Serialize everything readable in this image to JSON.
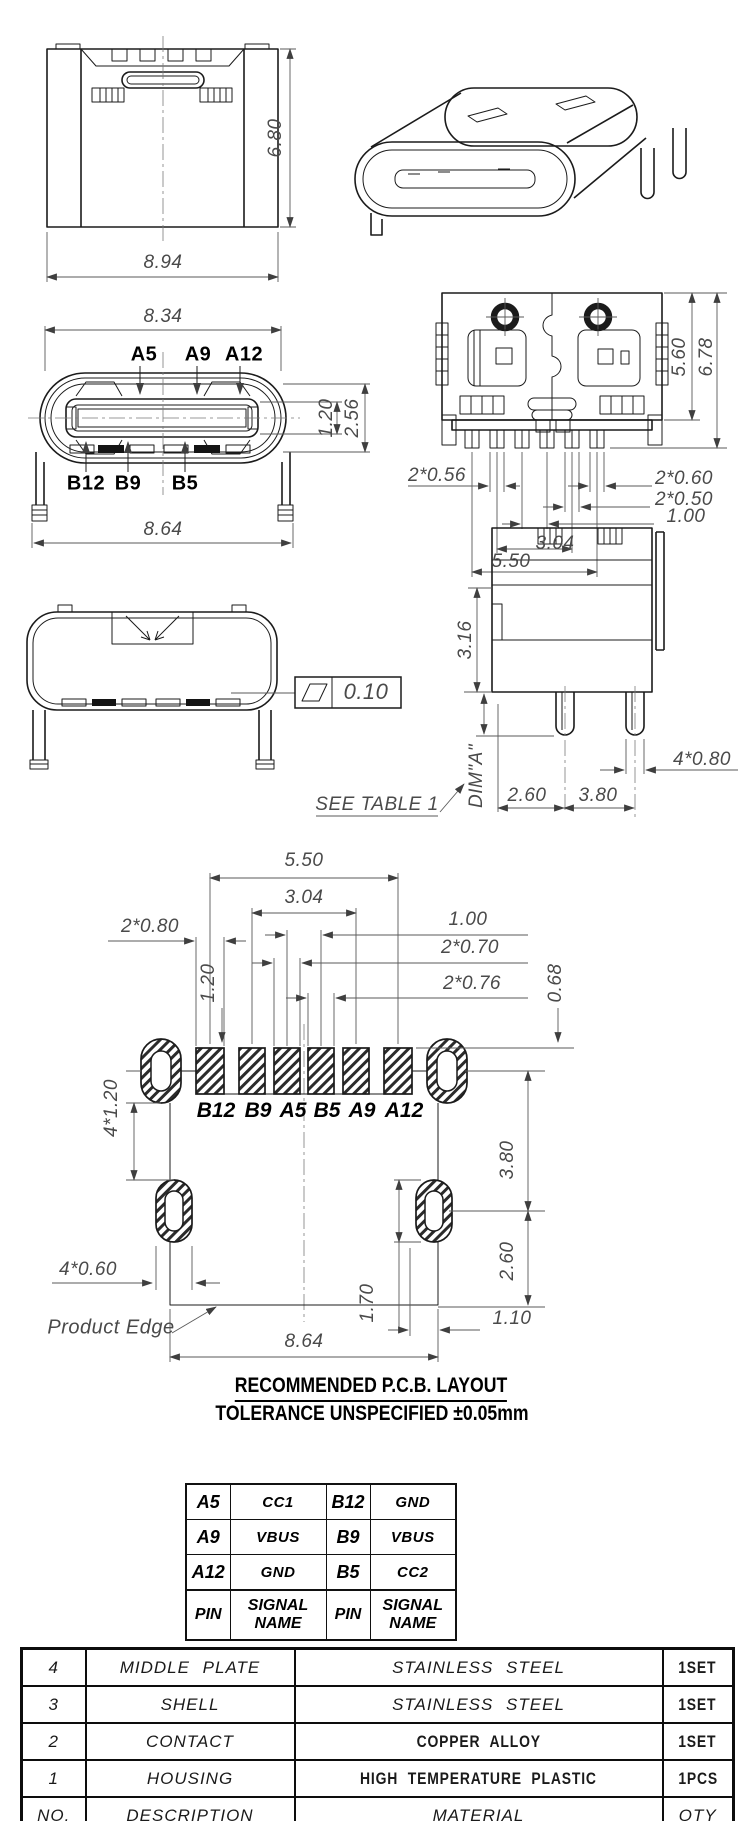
{
  "drawing": {
    "rear_view": {
      "height": "6.80",
      "width": "8.94"
    },
    "front_view": {
      "width_top": "8.34",
      "width_bottom": "8.64",
      "tongue_thickness": "1.20",
      "cavity_height": "2.56",
      "pin_labels_top": [
        "A5",
        "A9",
        "A12"
      ],
      "pin_labels_bottom": [
        "B12",
        "B9",
        "B5"
      ]
    },
    "bottom_view": {
      "body_height": "5.60",
      "total_height": "6.78",
      "pin_width_outer": "2*0.56",
      "pin_width_edge": "2*0.60",
      "pin_width_inner": "2*0.50",
      "pin_pitch_center": "1.00",
      "pin_span_mid": "3.04",
      "pin_span": "5.50"
    },
    "shell_view": {
      "flatness": "0.10",
      "see_table": "SEE  TABLE  1"
    },
    "side_view": {
      "height_above": "3.16",
      "dim_a": "DIM\"A\"",
      "leg_offset": "2.60",
      "leg_pitch": "3.80",
      "leg_width": "4*0.80"
    }
  },
  "pcb": {
    "title": "RECOMMENDED    P.C.B.  LAYOUT",
    "tolerance_note": "TOLERANCE  UNSPECIFIED  ±0.05mm",
    "product_edge_label": "Product Edge",
    "pad_labels": [
      "B12",
      "B9",
      "A5",
      "B5",
      "A9",
      "A12"
    ],
    "dims": {
      "pad_span": "5.50",
      "pad_span_mid": "3.04",
      "pad_pitch_center": "1.00",
      "pad_width_edge": "2*0.80",
      "pad_width_a": "2*0.70",
      "pad_width_b": "2*0.76",
      "offset_right": "0.68",
      "offset_left": "1.20",
      "hole_height": "4*1.20",
      "hole_width": "4*0.60",
      "hole_v_pitch": "3.80",
      "hole_edge_offset": "2.60",
      "slot_height": "1.70",
      "edge_offset": "1.10",
      "board_width": "8.64"
    }
  },
  "pin_table": {
    "rows": [
      [
        "A5",
        "CC1",
        "B12",
        "GND"
      ],
      [
        "A9",
        "VBUS",
        "B9",
        "VBUS"
      ],
      [
        "A12",
        "GND",
        "B5",
        "CC2"
      ]
    ],
    "header": [
      "PIN",
      "SIGNAL NAME",
      "PIN",
      "SIGNAL NAME"
    ]
  },
  "bom_table": {
    "rows": [
      [
        "4",
        "MIDDLE PLATE",
        "STAINLESS STEEL",
        "1SET"
      ],
      [
        "3",
        "SHELL",
        "STAINLESS STEEL",
        "1SET"
      ],
      [
        "2",
        "CONTACT",
        "COPPER ALLOY",
        "1SET"
      ],
      [
        "1",
        "HOUSING",
        "HIGH TEMPERATURE PLASTIC",
        "1PCS"
      ]
    ],
    "footer": [
      "NO.",
      "DESCRIPTION",
      "MATERIAL",
      "QTY"
    ]
  }
}
